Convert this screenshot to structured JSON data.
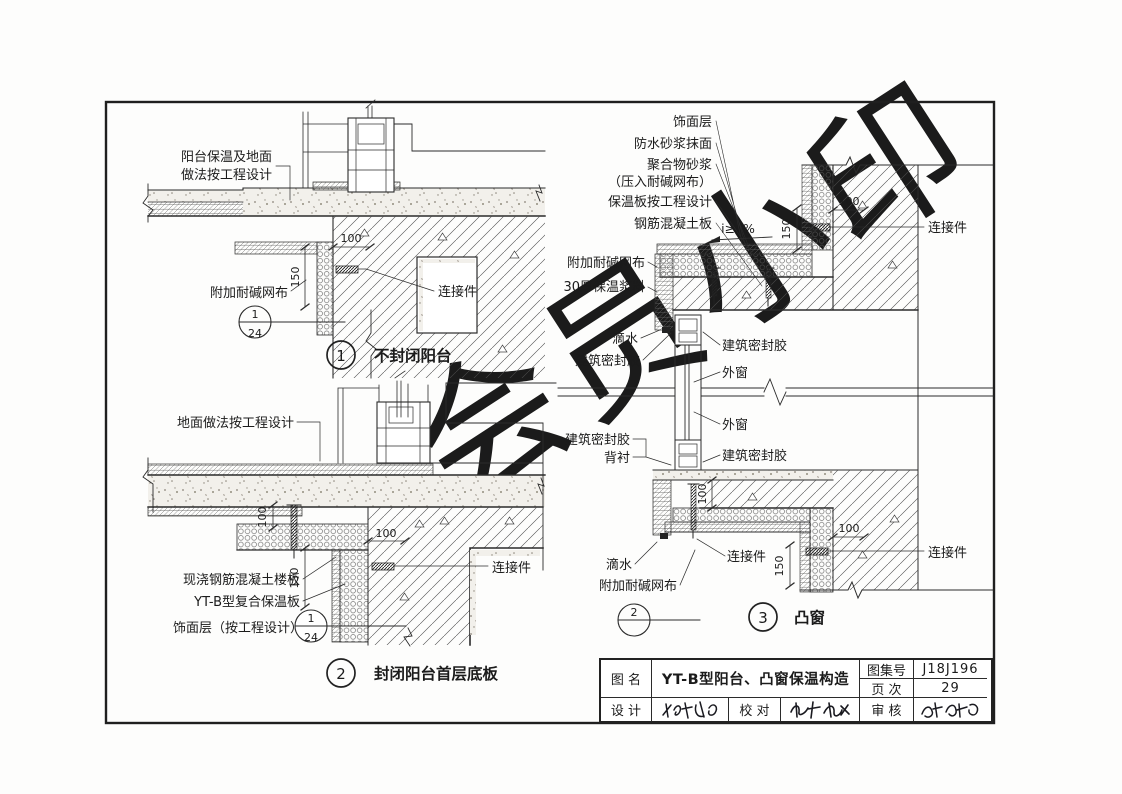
{
  "watermark": "会员小印",
  "d1": {
    "note1": "阳台保温及地面",
    "note2": "做法按工程设计",
    "mesh": "附加耐碱网布",
    "connector": "连接件",
    "dim_100": "100",
    "dim_150": "150",
    "ref_num": "1",
    "ref_den": "24",
    "num": "1",
    "title": "不封闭阳台"
  },
  "d2": {
    "floor_note": "地面做法按工程设计",
    "slab": "现浇钢筋混凝土楼板",
    "board": "YT-B型复合保温板",
    "finish": "饰面层（按工程设计）",
    "connector": "连接件",
    "dim_100v": "100",
    "dim_100h": "100",
    "dim_150": "150",
    "ref_num": "1",
    "ref_den": "24",
    "num": "2",
    "title": "封闭阳台首层底板"
  },
  "d3": {
    "finish": "饰面层",
    "waterproof": "防水砂浆抹面",
    "polymer": "聚合物砂浆",
    "polymer2": "（压入耐碱网布）",
    "board": "保温板按工程设计",
    "rc_slab": "钢筋混凝土板",
    "slope": "i≥5%",
    "mesh_top": "附加耐碱网布",
    "slurry": "30厚保温浆料",
    "drip_top": "滴水",
    "sealant_tl": "建筑密封胶",
    "sealant_tr": "建筑密封胶",
    "window_top": "外窗",
    "window_bottom": "外窗",
    "sealant_bl": "建筑密封胶",
    "backing": "背衬",
    "sealant_br": "建筑密封胶",
    "drip_bottom": "滴水",
    "connector_mid": "连接件",
    "mesh_bottom": "附加耐碱网布",
    "connector_top_right": "连接件",
    "connector_bottom_right": "连接件",
    "dim_150_top": "150",
    "dim_100_top": "100",
    "dim_100_mid": "100",
    "dim_150_bottom": "150",
    "dim_100_bottom": "100",
    "ref_num": "2",
    "ref_den": "",
    "num": "3",
    "title": "凸窗"
  },
  "titleblock": {
    "name_label": "图 名",
    "name_value": "YT-B型阳台、凸窗保温构造",
    "atlas_label": "图集号",
    "atlas_value": "J18J196",
    "page_label": "页 次",
    "page_value": "29",
    "design_label": "设 计",
    "proof_label": "校 对",
    "review_label": "审 核"
  }
}
